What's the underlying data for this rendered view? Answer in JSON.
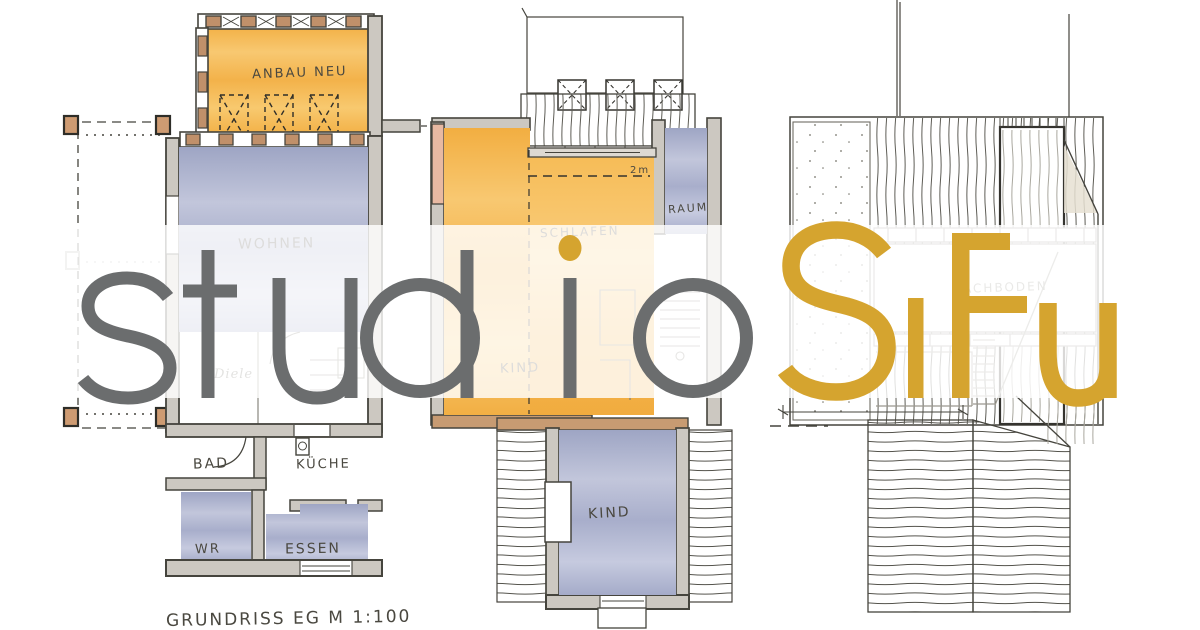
{
  "branding": {
    "studio_text": "studio",
    "sifu_text": "SiFu",
    "studio_color": "#6B6D6E",
    "sifu_color": "#D5A42F"
  },
  "plans": {
    "left": {
      "caption": "GRUNDRISS EG  M 1:100",
      "rooms": {
        "anbau": "ANBAU NEU",
        "wohnen": "WOHNEN",
        "diele": "Diele",
        "bad": "BAD",
        "kueche": "KÜCHE",
        "wr": "WR",
        "essen": "ESSEN"
      }
    },
    "middle": {
      "rooms": {
        "schlafen": "SCHLAFEN",
        "raum": "RAUM",
        "kind_upper": "KIND",
        "kind_lower": "KIND"
      },
      "annotation_headroom": "2m"
    },
    "right": {
      "rooms": {
        "dachboden": "DACHBODEN"
      }
    }
  },
  "colors": {
    "watercolor_orange": "#F4B248",
    "watercolor_blue": "#A9AFCB",
    "ink": "#45443D",
    "wall_fill": "#CCC8C1",
    "wood": "#C0906A"
  }
}
